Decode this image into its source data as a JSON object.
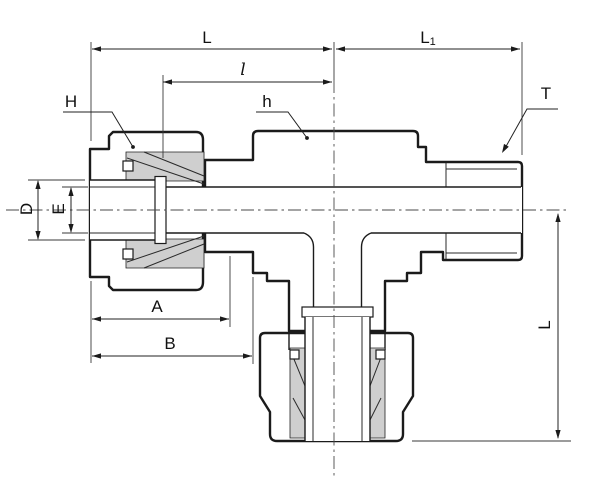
{
  "drawing": {
    "kind": "tube-fitting-cross-section-branch-tee",
    "background": "#ffffff",
    "line_color": "#1b1b1b",
    "nut_fill": "#b7b7b7",
    "body_fill": "#d2d2d2",
    "cavity_fill": "#cfcfcf",
    "dimensions": {
      "top_run_length": "L",
      "tube_insertion_length": "l",
      "right_run_length_base": "L",
      "right_run_length_sub": "1",
      "left_nut_hex": "H",
      "body_hex": "h",
      "thread_size": "T",
      "tube_hole_diameter": "D",
      "bore_diameter": "E",
      "nut_length": "A",
      "shoulder_length": "B",
      "branch_drop_length": "L"
    }
  }
}
